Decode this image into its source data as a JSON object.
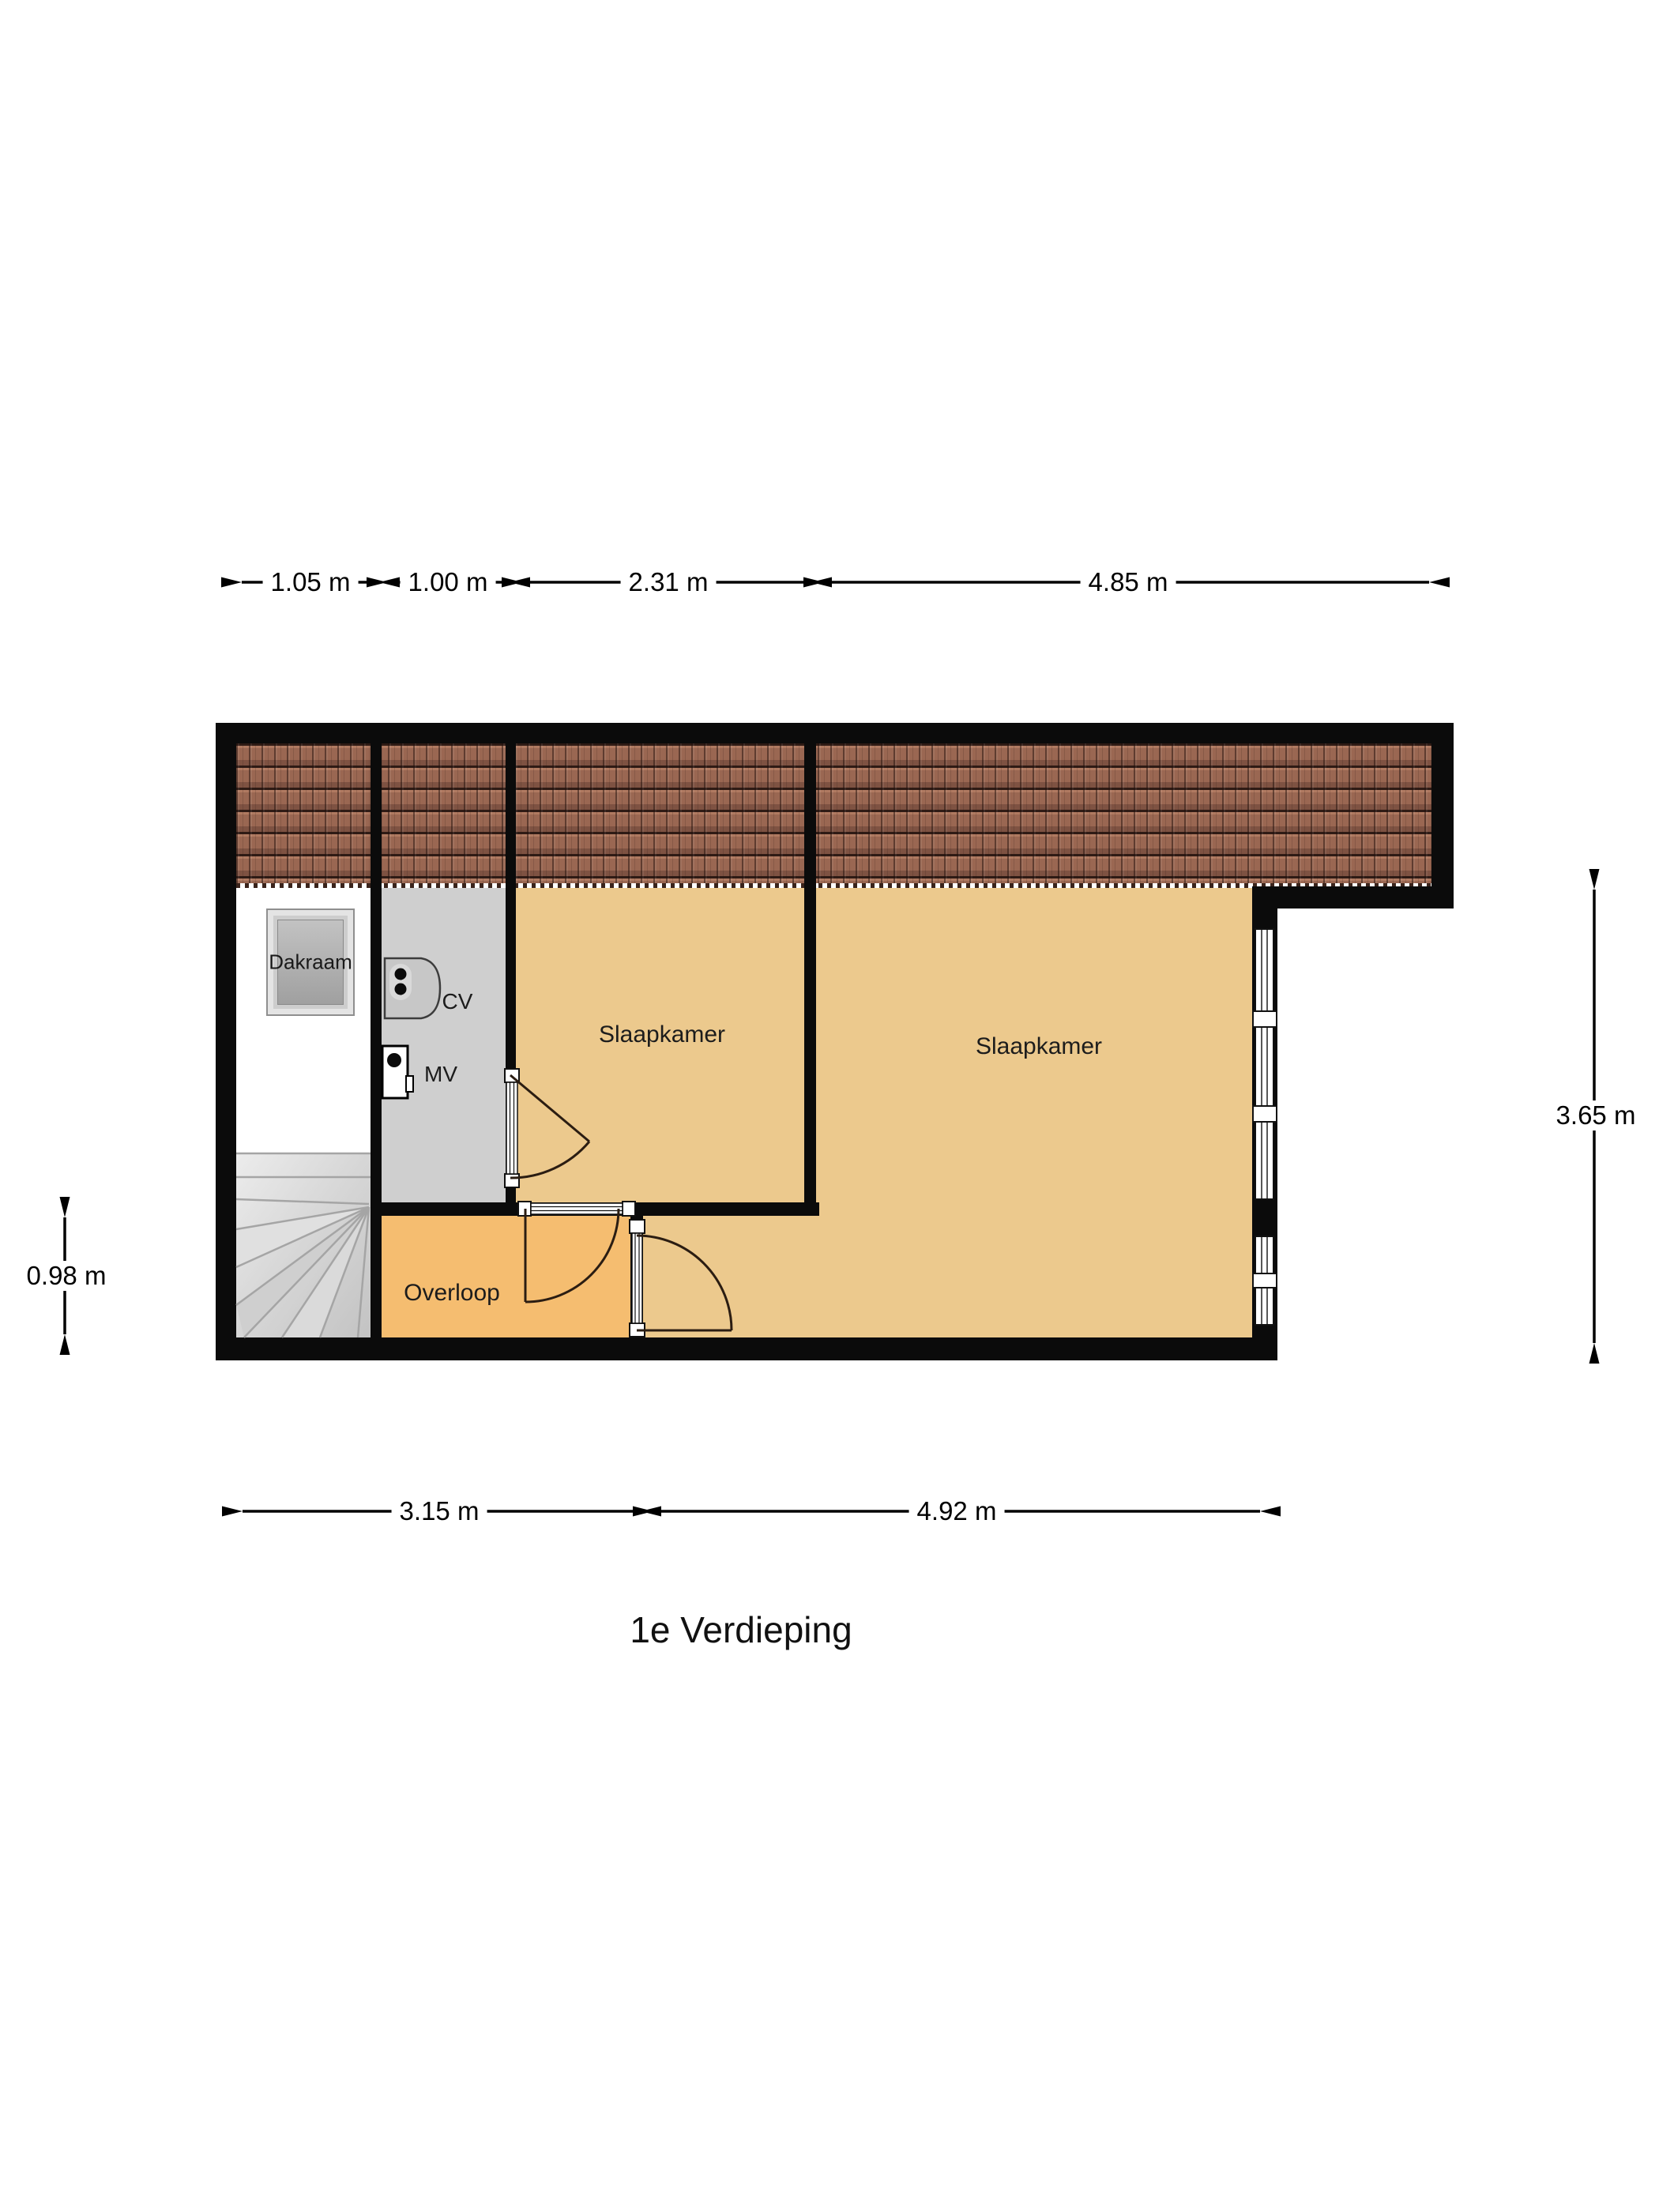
{
  "title": "1e Verdieping",
  "rooms": {
    "bedroom_small": {
      "label": "Slaapkamer"
    },
    "bedroom_large": {
      "label": "Slaapkamer"
    },
    "landing": {
      "label": "Overloop"
    }
  },
  "fixtures": {
    "roof_window": {
      "label": "Dakraam"
    },
    "boiler": {
      "label": "CV"
    },
    "ventilation": {
      "label": "MV"
    }
  },
  "dimensions": {
    "top": [
      "1.05 m",
      "1.00 m",
      "2.31 m",
      "4.85 m"
    ],
    "bottom": [
      "3.15 m",
      "4.92 m"
    ],
    "left": [
      "0.98 m"
    ],
    "right": [
      "3.65 m"
    ]
  },
  "colors": {
    "wall": "#0b0b0b",
    "bedroom_floor": "#ecc98d",
    "landing_floor": "#f5bd70",
    "closet_floor": "#cfcfcf",
    "roof_tiles": "#9a6752",
    "stairs": "#d6d6d6"
  }
}
